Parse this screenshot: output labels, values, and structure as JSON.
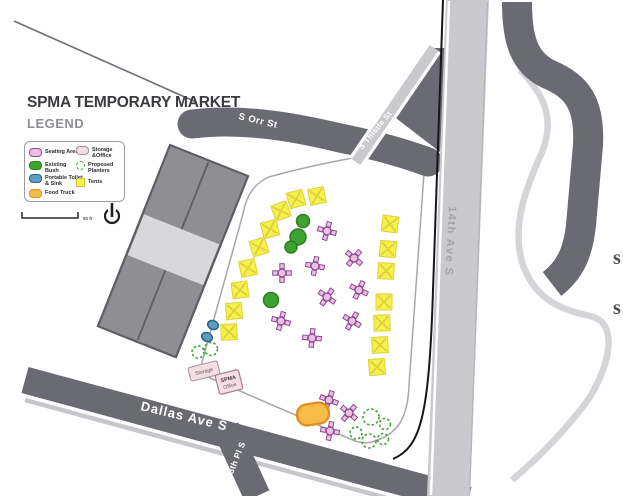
{
  "title": "SPMA TEMPORARY MARKET",
  "legend": {
    "heading": "LEGEND",
    "items": [
      {
        "key": "seating",
        "label": "Seating Area"
      },
      {
        "key": "bush",
        "label": "Existing Bush"
      },
      {
        "key": "toilet",
        "label": "Portable Toilet & Sink"
      },
      {
        "key": "foodtruck",
        "label": "Food Truck"
      },
      {
        "key": "storage",
        "label": "Storage &Office"
      },
      {
        "key": "planters",
        "label": "Proposed Planters"
      },
      {
        "key": "tents",
        "label": "Tents"
      }
    ]
  },
  "scale": {
    "distance_label": "50 ft"
  },
  "streets": {
    "s_orr": "S Orr St",
    "s_thistle": "S Thistle St",
    "fourteenth_ave": "14th Ave S",
    "dallas_ave": "Dallas Ave S",
    "thirteenth_pl": "13th Pl S"
  },
  "structures": {
    "storage_label": "Storage",
    "office_line1": "SPMA",
    "office_line2": "Office"
  },
  "edge_letters": [
    "s",
    "s"
  ],
  "colors": {
    "road_dark": "#6a6a73",
    "road_light": "#c9c9ce",
    "path_light": "#d5d5d9",
    "building_fill": "#8f8f93",
    "building_band": "#d8d8db",
    "building_outline": "#5d5d63",
    "market_outline": "#a7a7ab",
    "tent_fill": "#f7ef4d",
    "tent_x": "#dcd23b",
    "seating_fill": "#ecc0e4",
    "seating_outline": "#8d4a91",
    "bush_fill": "#3da32f",
    "bush_outline": "#2c7e22",
    "toilet_fill": "#5e9dc2",
    "toilet_outline": "#2a6486",
    "planter_stroke": "#43a339",
    "truck_fill": "#f7bc47",
    "truck_outline": "#df9020",
    "storage_fill": "#f2dee3",
    "storage_outline": "#a98e99",
    "text_dark": "#3b3b3f",
    "legend_gray": "#8e8e93",
    "street_text": "#ffffff",
    "ave14_text": "#a3a3a9"
  },
  "markers": {
    "tents": [
      {
        "x": 296,
        "y": 199,
        "rot": -15
      },
      {
        "x": 317,
        "y": 196,
        "rot": -12
      },
      {
        "x": 281,
        "y": 211,
        "rot": -20
      },
      {
        "x": 270,
        "y": 229,
        "rot": -15
      },
      {
        "x": 259,
        "y": 247,
        "rot": -18
      },
      {
        "x": 248,
        "y": 268,
        "rot": -12
      },
      {
        "x": 240,
        "y": 290,
        "rot": -8
      },
      {
        "x": 234,
        "y": 311,
        "rot": -5
      },
      {
        "x": 229,
        "y": 332,
        "rot": -3
      },
      {
        "x": 390,
        "y": 224,
        "rot": 8
      },
      {
        "x": 388,
        "y": 249,
        "rot": 5
      },
      {
        "x": 386,
        "y": 271,
        "rot": 3
      },
      {
        "x": 384,
        "y": 302,
        "rot": 0
      },
      {
        "x": 382,
        "y": 323,
        "rot": -2
      },
      {
        "x": 380,
        "y": 345,
        "rot": -3
      },
      {
        "x": 377,
        "y": 367,
        "rot": -5
      }
    ],
    "seating": [
      {
        "x": 327,
        "y": 231,
        "rot": 15
      },
      {
        "x": 354,
        "y": 258,
        "rot": 40
      },
      {
        "x": 315,
        "y": 266,
        "rot": 10
      },
      {
        "x": 282,
        "y": 273,
        "rot": 0
      },
      {
        "x": 359,
        "y": 290,
        "rot": 25
      },
      {
        "x": 327,
        "y": 297,
        "rot": 35
      },
      {
        "x": 281,
        "y": 321,
        "rot": 15
      },
      {
        "x": 352,
        "y": 321,
        "rot": 30
      },
      {
        "x": 312,
        "y": 338,
        "rot": 5
      },
      {
        "x": 329,
        "y": 400,
        "rot": 20
      },
      {
        "x": 349,
        "y": 413,
        "rot": 40
      },
      {
        "x": 330,
        "y": 431,
        "rot": 10
      }
    ],
    "bushes": [
      {
        "x": 303,
        "y": 221,
        "r": 6.5
      },
      {
        "x": 298,
        "y": 237,
        "r": 8
      },
      {
        "x": 291,
        "y": 247,
        "r": 6
      },
      {
        "x": 271,
        "y": 300,
        "r": 7.5
      }
    ],
    "toilets": [
      {
        "x": 213,
        "y": 325
      },
      {
        "x": 207,
        "y": 337
      }
    ],
    "planters": [
      {
        "x": 198,
        "y": 352,
        "r": 6
      },
      {
        "x": 211,
        "y": 349,
        "r": 6.5
      },
      {
        "x": 371,
        "y": 417,
        "r": 8
      },
      {
        "x": 385,
        "y": 424,
        "r": 5.5
      },
      {
        "x": 356,
        "y": 433,
        "r": 6
      },
      {
        "x": 369,
        "y": 441,
        "r": 7
      },
      {
        "x": 383,
        "y": 439,
        "r": 5.5
      }
    ],
    "food_truck": {
      "x": 313,
      "y": 414,
      "rot": -9
    }
  }
}
